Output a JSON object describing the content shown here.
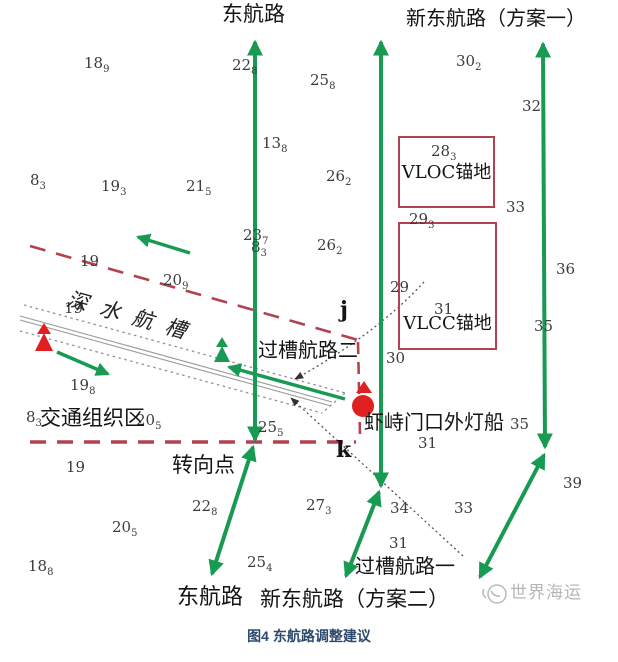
{
  "caption": "图4 东航路调整建议",
  "labels": {
    "route_east_top": "东航路",
    "route_new_east_plan1": "新东航路（方案一）",
    "route_east_bottom": "东航路",
    "route_new_east_plan2": "新东航路（方案二）",
    "deep_water_channel": "深水航槽",
    "cross_route_2": "过槽航路二",
    "cross_route_1": "过槽航路一",
    "traffic_zone": "交通组织区",
    "turning_point": "转向点",
    "lightship": "虾峙门口外灯船",
    "vloc_anchorage": "VLOC锚地",
    "vlcc_anchorage": "VLCC锚地",
    "point_j": "j",
    "point_k": "k",
    "watermark": "世界海运"
  },
  "colors": {
    "route_green": "#189a52",
    "boundary_red": "#b24250",
    "anchorage_border_red": "#b24250",
    "mark_red": "#e02020",
    "caption_navy": "#2d4a6e",
    "sounding_gray": "#3c3c3c",
    "channel_gray": "#999999",
    "watermark_gray": "#b4b7b9"
  },
  "soundings": [
    {
      "t": "18",
      "s": "9",
      "x": 84,
      "y": 54
    },
    {
      "t": "22",
      "s": "8",
      "x": 232,
      "y": 56
    },
    {
      "t": "25",
      "s": "8",
      "x": 310,
      "y": 71
    },
    {
      "t": "30",
      "s": "2",
      "x": 456,
      "y": 52
    },
    {
      "t": "32",
      "s": "",
      "x": 522,
      "y": 97
    },
    {
      "t": "13",
      "s": "8",
      "x": 262,
      "y": 134
    },
    {
      "t": "8",
      "s": "3",
      "x": 30,
      "y": 171
    },
    {
      "t": "19",
      "s": "3",
      "x": 101,
      "y": 177
    },
    {
      "t": "21",
      "s": "5",
      "x": 186,
      "y": 177
    },
    {
      "t": "26",
      "s": "2",
      "x": 326,
      "y": 167
    },
    {
      "t": "28",
      "s": "3",
      "x": 431,
      "y": 142
    },
    {
      "t": "33",
      "s": "",
      "x": 506,
      "y": 198
    },
    {
      "t": "29",
      "s": "3",
      "x": 409,
      "y": 210
    },
    {
      "t": "23",
      "s": "7",
      "x": 243,
      "y": 226
    },
    {
      "t": "8",
      "s": "3",
      "x": 251,
      "y": 238
    },
    {
      "t": "26",
      "s": "2",
      "x": 317,
      "y": 236
    },
    {
      "t": "19",
      "s": "",
      "x": 80,
      "y": 252
    },
    {
      "t": "20",
      "s": "9",
      "x": 163,
      "y": 271
    },
    {
      "t": "36",
      "s": "",
      "x": 556,
      "y": 260
    },
    {
      "t": "29",
      "s": "",
      "x": 390,
      "y": 278
    },
    {
      "t": "31",
      "s": "",
      "x": 434,
      "y": 300
    },
    {
      "t": "35",
      "s": "",
      "x": 534,
      "y": 317
    },
    {
      "t": "19",
      "s": "",
      "x": 64,
      "y": 299
    },
    {
      "t": "30",
      "s": "",
      "x": 386,
      "y": 349
    },
    {
      "t": "19",
      "s": "8",
      "x": 70,
      "y": 376
    },
    {
      "t": "8",
      "s": "3",
      "x": 26,
      "y": 408
    },
    {
      "t": "20",
      "s": "5",
      "x": 136,
      "y": 411
    },
    {
      "t": "25",
      "s": "5",
      "x": 258,
      "y": 418
    },
    {
      "t": "35",
      "s": "",
      "x": 510,
      "y": 415
    },
    {
      "t": "31",
      "s": "",
      "x": 418,
      "y": 434
    },
    {
      "t": "19",
      "s": "",
      "x": 66,
      "y": 458
    },
    {
      "t": "22",
      "s": "8",
      "x": 192,
      "y": 497
    },
    {
      "t": "27",
      "s": "3",
      "x": 306,
      "y": 496
    },
    {
      "t": "34",
      "s": "",
      "x": 390,
      "y": 499
    },
    {
      "t": "33",
      "s": "",
      "x": 454,
      "y": 499
    },
    {
      "t": "39",
      "s": "",
      "x": 563,
      "y": 474
    },
    {
      "t": "31",
      "s": "",
      "x": 389,
      "y": 534
    },
    {
      "t": "20",
      "s": "5",
      "x": 112,
      "y": 518
    },
    {
      "t": "25",
      "s": "4",
      "x": 247,
      "y": 553
    },
    {
      "t": "18",
      "s": "8",
      "x": 28,
      "y": 557
    }
  ]
}
